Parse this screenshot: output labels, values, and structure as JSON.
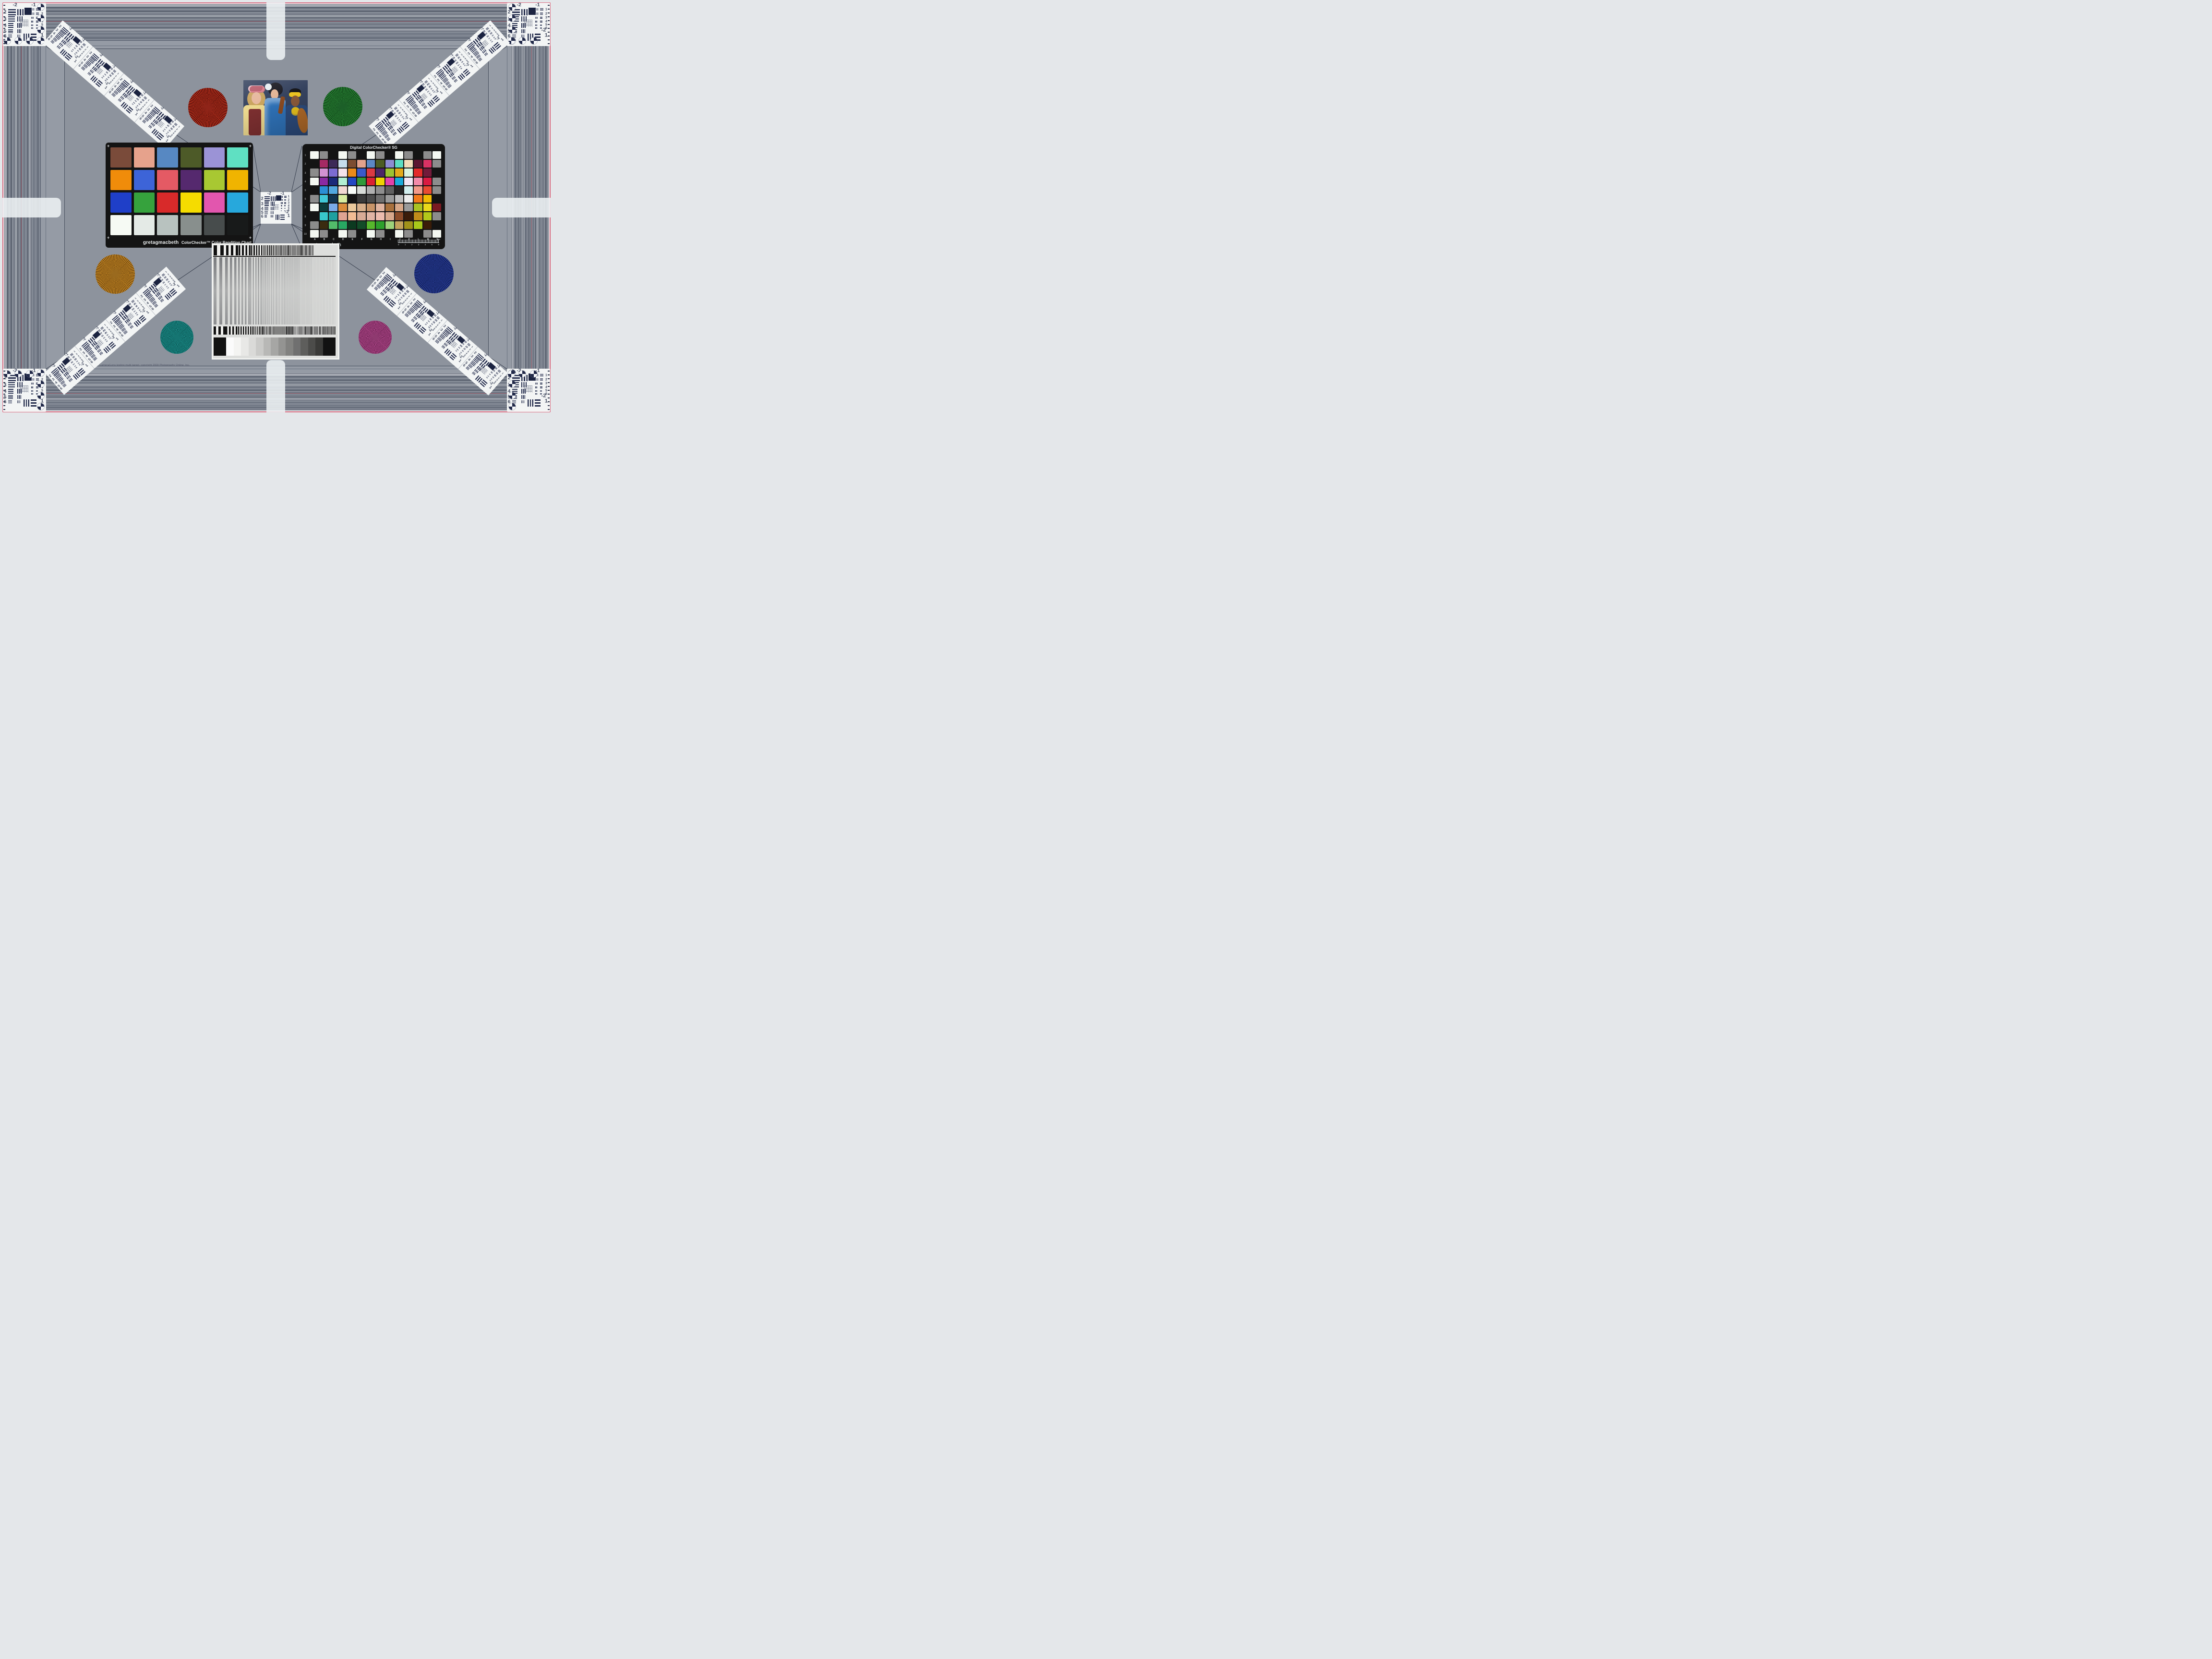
{
  "frame": {
    "pink": "#d96b80"
  },
  "copyright": "Camera/Lens testing multi-target, copyright 2009 Photography Online, Inc.",
  "colorchecker": {
    "brand": "gretagmacbeth",
    "title": "ColorChecker™ Color Rendition Chart",
    "corner_mark": "+",
    "patches": [
      "#7a4b3a",
      "#e6a28c",
      "#5788c2",
      "#4d5a28",
      "#9b93d6",
      "#5fe0c2",
      "#f08c0a",
      "#3d64d8",
      "#e45a64",
      "#55296e",
      "#a8c832",
      "#f0b400",
      "#1f3fc8",
      "#36a23d",
      "#d82a2a",
      "#f5dc00",
      "#e256ae",
      "#27a8dc",
      "#f6faf4",
      "#e4eae6",
      "#b8c2bf",
      "#888f8d",
      "#474c4c",
      "#181a1a"
    ]
  },
  "sg": {
    "title": "Digital ColorChecker® SG",
    "brand": "gretagmacbeth",
    "row_labels": [
      "1",
      "2",
      "3",
      "4",
      "5",
      "6",
      "7",
      "8",
      "9",
      "10"
    ],
    "col_labels": [
      "A",
      "B",
      "C",
      "D",
      "E",
      "F",
      "G",
      "H",
      "I",
      "J",
      "K",
      "L",
      "M",
      "N"
    ],
    "ruler_numbers": [
      "0",
      "1",
      "2",
      "3",
      "4",
      "5",
      "6"
    ],
    "ruler_unit": "mm",
    "rows": [
      [
        "#f4f8f2",
        "#8c8c8c",
        "#141414",
        "#f4f8f2",
        "#8c8c8c",
        "#141414",
        "#f4f8f2",
        "#8c8c8c",
        "#141414",
        "#f4f8f2",
        "#8c8c8c",
        "#141414",
        "#8c8c8c",
        "#f4f8f2"
      ],
      [
        "#141414",
        "#a42a64",
        "#3c2a58",
        "#c6dcec",
        "#7c4c30",
        "#e2a28c",
        "#5c88c4",
        "#4c5c24",
        "#8c8cd2",
        "#5cdcc2",
        "#f2dab8",
        "#5c1430",
        "#da3264",
        "#8c8c8c"
      ],
      [
        "#8c8c8c",
        "#d292d2",
        "#7c6cd2",
        "#f6e2ea",
        "#ea8a1a",
        "#3a5aca",
        "#da3a42",
        "#4c2668",
        "#9cc232",
        "#e2aa1a",
        "#daf2de",
        "#e22a2a",
        "#721a3a",
        "#141414"
      ],
      [
        "#f4f8f2",
        "#8a2aa2",
        "#1a2a7a",
        "#b2eed2",
        "#2248c2",
        "#309a3a",
        "#da2132",
        "#eed202",
        "#e242aa",
        "#1aaada",
        "#f2e6f6",
        "#f28aaa",
        "#da1a42",
        "#8c8c8c"
      ],
      [
        "#141414",
        "#2b8fd5",
        "#52a8e0",
        "#f2d8d2",
        "#f8fcf8",
        "#d8dcd8",
        "#b0b0b0",
        "#8e8e8e",
        "#606060",
        "#262626",
        "#d2eeee",
        "#f29a8a",
        "#ea4a32",
        "#8c8c8c"
      ],
      [
        "#8c8c8c",
        "#40c8d8",
        "#12334f",
        "#d8eca0",
        "#141414",
        "#3a3a3a",
        "#4c4c4c",
        "#6e6e6e",
        "#9a9a9a",
        "#c0c0c0",
        "#ececec",
        "#f27a1a",
        "#f2ba02",
        "#141414"
      ],
      [
        "#f4f8f2",
        "#0c3d3d",
        "#7aaae8",
        "#da8c3c",
        "#ecc99c",
        "#d8b08c",
        "#c89468",
        "#e0b4a0",
        "#a8703c",
        "#d8a888",
        "#9a9a9a",
        "#aac222",
        "#ead81a",
        "#7a1a22"
      ],
      [
        "#141414",
        "#38c8cc",
        "#1fa0a0",
        "#dfa492",
        "#f2bc94",
        "#d8ab96",
        "#e0b4a4",
        "#ecbcae",
        "#d8a88c",
        "#8c4c2a",
        "#3a1c0a",
        "#c08c1a",
        "#b2c81a",
        "#8c8c8c"
      ],
      [
        "#8c8c8c",
        "#3a2c10",
        "#52bc6a",
        "#28a862",
        "#0c3a20",
        "#124c28",
        "#56b82c",
        "#2ca02c",
        "#9cd27a",
        "#c2a25c",
        "#a0921a",
        "#a8c81a",
        "#3a1c08",
        "#141414"
      ],
      [
        "#f4f8f2",
        "#8c8c8c",
        "#141414",
        "#f4f8f2",
        "#8c8c8c",
        "#141414",
        "#f4f8f2",
        "#8c8c8c",
        "#141414",
        "#f4f8f2",
        "#8c8c8c",
        "#141414",
        "#8c8c8c",
        "#f4f8f2"
      ]
    ]
  },
  "usaf": {
    "headers": [
      "-2",
      "-1"
    ],
    "left_numbers": [
      "2",
      "3",
      "4",
      "5",
      "6"
    ],
    "right_numbers": [
      "1",
      "2",
      "3",
      "4",
      "5",
      "6"
    ],
    "bottom_right_top": "-2",
    "bottom_right_bottom": "1"
  },
  "stars": [
    {
      "name": "red-star",
      "light": "#c4341f",
      "dark": "#4a0d08",
      "core": "#8f2418"
    },
    {
      "name": "green-star",
      "light": "#2e8f3a",
      "dark": "#0c3a14",
      "core": "#1c5f28"
    },
    {
      "name": "orange-star",
      "light": "#cc8c24",
      "dark": "#6a4410",
      "core": "#9a6a1e"
    },
    {
      "name": "blue-star",
      "light": "#2a3f9e",
      "dark": "#101c50",
      "core": "#1c2f78"
    },
    {
      "name": "teal-star",
      "light": "#1d9a96",
      "dark": "#0a4a48",
      "core": "#157572"
    },
    {
      "name": "magenta-star",
      "light": "#c05096",
      "dark": "#5e1c48",
      "core": "#8f3a70"
    }
  ],
  "photo": {
    "background": "#35425e",
    "left_hair": "#c9a35c",
    "left_crown": "#b85a6a",
    "left_face": "#e6b79c",
    "left_blouse": "#ecd88e",
    "left_vest": "#7c2f30",
    "mid_hair": "#1a1a22",
    "mid_flower": "#e8eef2",
    "mid_face": "#e2b394",
    "mid_dress": "#2f72b8",
    "right_face": "#8a5a3a",
    "right_band": "#ecc322",
    "right_hair": "#151518",
    "right_dress": "#2c4b7c",
    "right_necklace": "#e8c11c",
    "violin": "#8a4a20",
    "cello": "#b06a28"
  },
  "wedge": {
    "ramp": [
      "#fbfbfb",
      "#f4f4f2",
      "#e8e8e6",
      "#dadad8",
      "#cacac8",
      "#b8b8b6",
      "#a6a6a4",
      "#949492",
      "#828280",
      "#707070",
      "#5e5e5c",
      "#4c4c4a",
      "#3a3a38"
    ],
    "ramp_end": "#121212"
  }
}
